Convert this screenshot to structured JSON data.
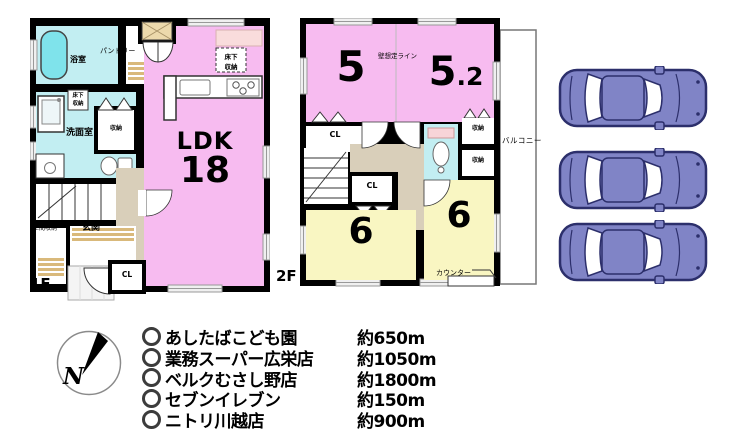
{
  "floor1": {
    "label": "1F",
    "ldk": {
      "name": "LDK",
      "size": "18"
    },
    "bath": "浴室",
    "pantry": "パントリー",
    "underfloor_a": {
      "line1": "床下",
      "line2": "収納"
    },
    "underfloor_b": {
      "line1": "床下",
      "line2": "収納"
    },
    "washroom": "洗面室",
    "storage": "収納",
    "doma_storage": "土間収納",
    "entrance": "玄関",
    "closet": "CL"
  },
  "floor2": {
    "label": "2F",
    "room5": "5",
    "room52_main": "5",
    "room52_frac": ".2",
    "wall_line": "壁想定ライン",
    "closet_top": "CL",
    "closet_mid": "CL",
    "storage_a": "収納",
    "storage_b": "収納",
    "balcony": "バルコニー",
    "room6_left": "6",
    "room6_right": "6",
    "counter": "カウンター"
  },
  "compass": {
    "north": "N"
  },
  "facilities": [
    {
      "name": "あしたばこども園",
      "distance": "約650m"
    },
    {
      "name": "業務スーパー広栄店",
      "distance": "約1050m"
    },
    {
      "name": "ベルクむさし野店",
      "distance": "約1800m"
    },
    {
      "name": "セブンイレブン",
      "distance": "約150m"
    },
    {
      "name": "ニトリ川越店",
      "distance": "約900m"
    }
  ],
  "colors": {
    "wall": "#000000",
    "room_pink": "#f7bbf0",
    "room_yellow": "#f9f6c2",
    "wet_cyan": "#c2eef2",
    "tub_cyan": "#7fe3eb",
    "tatami_tan": "#d9b97b",
    "hall_beige": "#d9cfba",
    "car_body": "#8084c6",
    "car_outline": "#2c2f6b"
  }
}
